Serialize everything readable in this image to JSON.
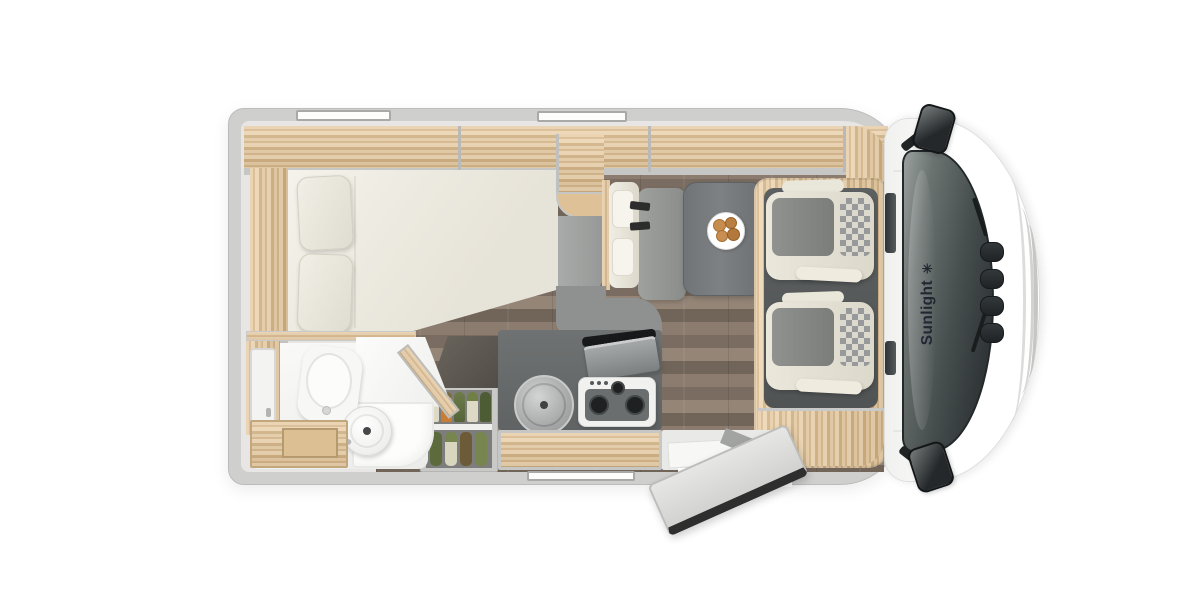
{
  "brand": {
    "label": "Sunlight",
    "icon": "sun-asterisk-icon",
    "icon_glyph": "✳"
  },
  "palette": {
    "vehicle_wall_gray": "#cfcfcd",
    "interior_base": "#e7e6e4",
    "cabinet_wood": "#e0c096",
    "floor_wood": "#817367",
    "kitchen_counter_gray": "#696c6c",
    "table_gray": "#75787a",
    "upholstery_cream": "#eae7db",
    "upholstery_gray": "#8f918f",
    "windshield_glass": "#3a4143",
    "logo_text": "#222833",
    "pantry_carrot": "#c97c33",
    "pantry_greens": "#6d7c49"
  }
}
